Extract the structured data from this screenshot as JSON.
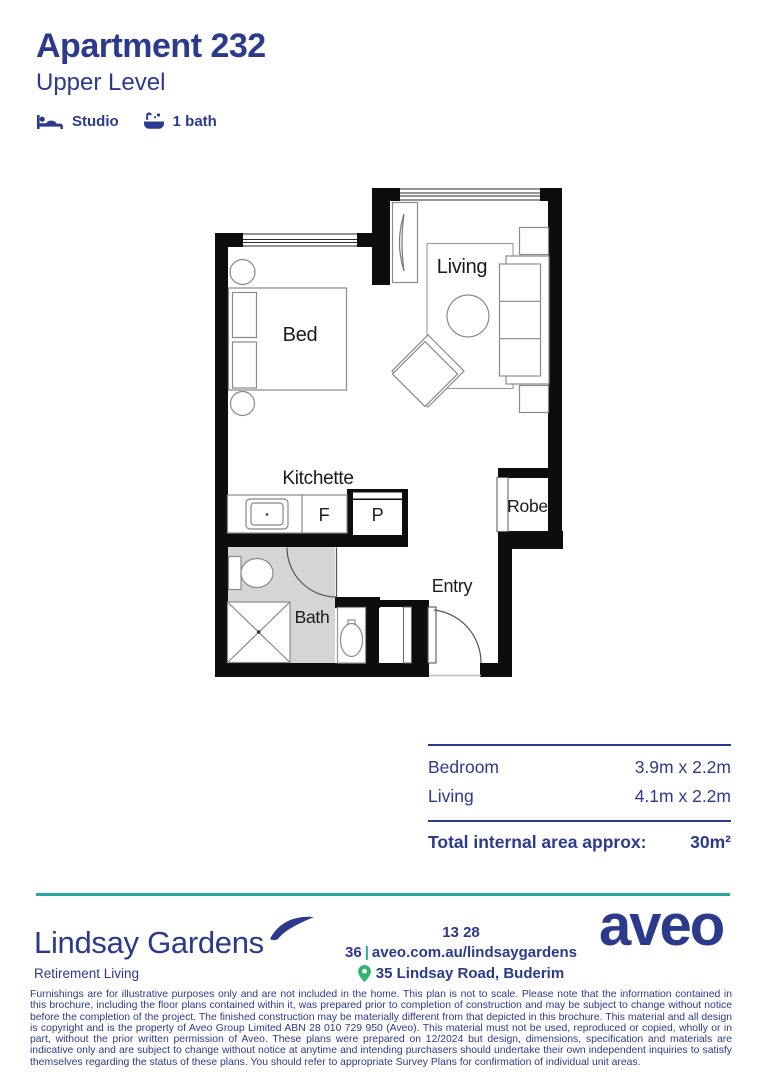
{
  "header": {
    "title": "Apartment 232",
    "subtitle": "Upper Level",
    "features": [
      {
        "icon": "bed-icon",
        "label": "Studio"
      },
      {
        "icon": "bath-icon",
        "label": "1 bath"
      }
    ]
  },
  "floorplan": {
    "labels": {
      "living": "Living",
      "bed": "Bed",
      "kitchenette": "Kitchette",
      "fridge": "F",
      "pantry": "P",
      "robe": "Robe",
      "bath": "Bath",
      "entry": "Entry"
    }
  },
  "dimensions_table": {
    "rows": [
      {
        "label": "Bedroom",
        "value": "3.9m x 2.2m"
      },
      {
        "label": "Living",
        "value": "4.1m x 2.2m"
      }
    ],
    "total_label": "Total internal area approx:",
    "total_value": "30m²"
  },
  "footer": {
    "community_name": "Lindsay Gardens",
    "community_tagline": "Retirement Living",
    "phone": "13 28 36",
    "separator": "|",
    "website": "aveo.com.au/lindsaygardens",
    "address": "35 Lindsay Road, Buderim",
    "brand": "aveo"
  },
  "disclaimer": "Furnishings are for illustrative purposes only and are not included in the home. This plan is not to scale. Please note that the information contained in this brochure, including the floor plans contained within it, was prepared prior to completion of construction and may be subject to change without notice before the completion of the project. The finished construction may be materially different from that depicted in this brochure. This material and all design is copyright and is the property of Aveo Group Limited ABN 28 010 729 950 (Aveo). This material must not be used, reproduced or copied, wholly or in part, without the prior written permission of Aveo. These plans were prepared on 12/2024 but design, dimensions, specification and materials are indicative only and are subject to change without notice at anytime and intending purchasers should undertake their own independent inquiries to satisfy themselves regarding the status of these plans. You should refer to appropriate Survey Plans for confirmation of individual unit areas.",
  "colors": {
    "navy": "#2B3A8C",
    "teal": "#2AA7A0",
    "pin_green": "#2EB56F",
    "wall_black": "#0d0d0d",
    "bath_floor_gray": "#d5d5d5"
  }
}
